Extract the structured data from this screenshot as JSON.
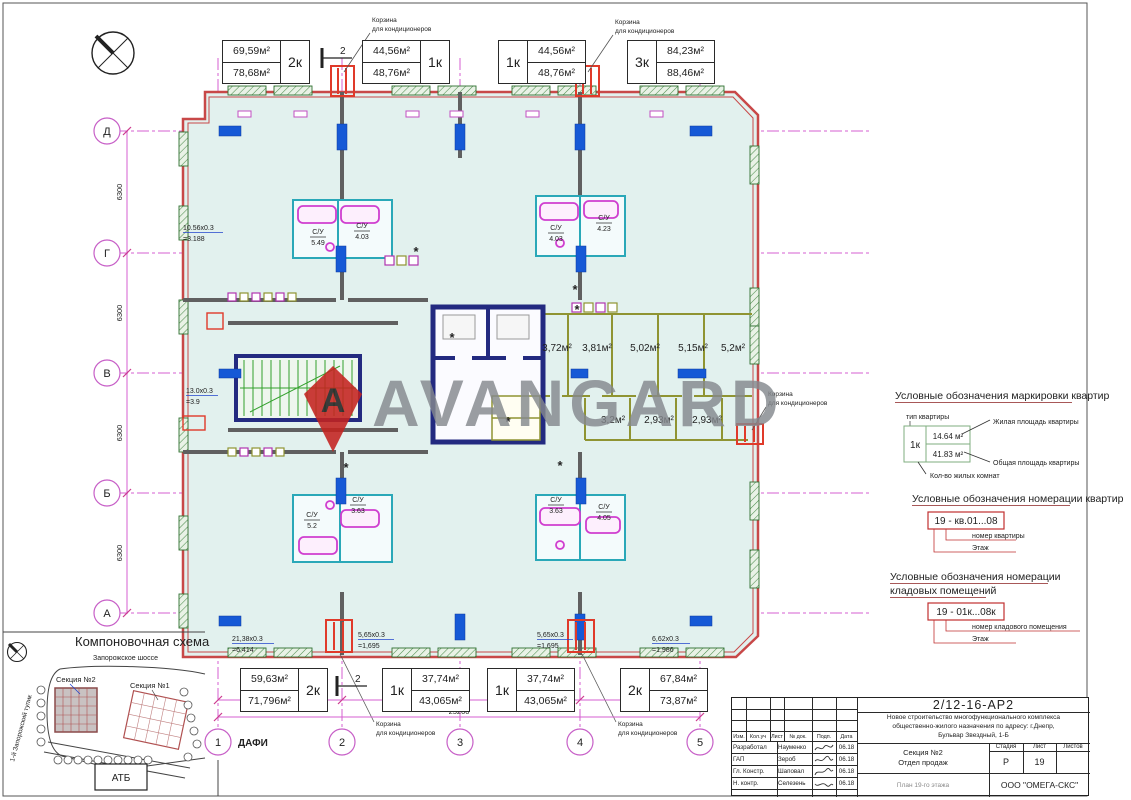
{
  "watermark": {
    "text": "AVANGARD",
    "logo_letter": "A"
  },
  "plan": {
    "section_mark": "2",
    "basket_line1": "Корзина",
    "basket_line2": "для кондиционеров",
    "apartments_top": [
      {
        "living": "69,59м²",
        "total": "78,68м²",
        "rooms": "2к"
      },
      {
        "living": "44,56м²",
        "total": "48,76м²",
        "rooms": "1к"
      },
      {
        "living": "44,56м²",
        "total": "48,76м²",
        "rooms": "1к"
      },
      {
        "living": "84,23м²",
        "total": "88,46м²",
        "rooms": "3к"
      }
    ],
    "apartments_bottom": [
      {
        "living": "59,63м²",
        "total": "71,796м²",
        "rooms": "2к"
      },
      {
        "living": "37,74м²",
        "total": "43,065м²",
        "rooms": "1к"
      },
      {
        "living": "37,74м²",
        "total": "43,065м²",
        "rooms": "1к"
      },
      {
        "living": "67,84м²",
        "total": "73,87м²",
        "rooms": "2к"
      }
    ],
    "storage_top": [
      "3,72м²",
      "3,81м²",
      "5,02м²",
      "5,15м²",
      "5,2м²"
    ],
    "storage_bottom": [
      "3,2м²",
      "2,93м²",
      "2,93м²"
    ],
    "bathrooms": [
      {
        "label": "С/У",
        "area": "5.49"
      },
      {
        "label": "С/У",
        "area": "4.03"
      },
      {
        "label": "С/У",
        "area": "4.03"
      },
      {
        "label": "С/У",
        "area": "4.23"
      },
      {
        "label": "С/У",
        "area": "5.2"
      },
      {
        "label": "С/У",
        "area": "3.63"
      },
      {
        "label": "С/У",
        "area": "3.63"
      },
      {
        "label": "С/У",
        "area": "4.05"
      }
    ],
    "balconies": [
      {
        "f": "10.56х0.3",
        "r": "=3.188"
      },
      {
        "f": "13.0х0.3",
        "r": "=3.9"
      },
      {
        "f": "21,38х0.3",
        "r": "=6,414"
      },
      {
        "f": "5,65х0.3",
        "r": "=1,695"
      },
      {
        "f": "5,65х0.3",
        "r": "=1,695"
      },
      {
        "f": "6,62х0.3",
        "r": "=1,986"
      }
    ],
    "axes_h": [
      "Д",
      "Г",
      "В",
      "Б",
      "А"
    ],
    "axes_v": [
      "1",
      "2",
      "3",
      "4",
      "5"
    ],
    "axis_note": "ДАФИ",
    "dim": "6300",
    "dim_total": "25200"
  },
  "legend1": {
    "title": "Условные обозначения маркировки квартир",
    "type_label": "тип квартиры",
    "type": "1к",
    "living": "14.64 м²",
    "total": "41.83 м²",
    "living_label": "Жилая площадь квартиры",
    "total_label": "Общая площадь квартиры",
    "rooms_label": "Кол-во жилых комнат"
  },
  "legend2": {
    "title": "Условные обозначения номерации квартир",
    "example": "19 - кв.01...08",
    "num_label": "номер квартиры",
    "floor_label": "Этаж"
  },
  "legend3": {
    "title1": "Условные обозначения номерации",
    "title2": "кладовых помещений",
    "example": "19 - 01к...08к",
    "num_label": "номер кладового помещения",
    "floor_label": "Этаж"
  },
  "site": {
    "title": "Компоновочная схема",
    "road": "Запорожское шоссе",
    "s2": "Секция №2",
    "s1": "Секция №1",
    "store": "АТБ",
    "street": "1-й Запорожский тупик"
  },
  "stamp": {
    "doc": "2/12-16-АР2",
    "project_lines": [
      "Новое строительство многофункционального комплекса",
      "общественно-жилого назначения по адресу: г.Днепр,",
      "Бульвар Звездный, 1-Б"
    ],
    "object1": "Секция №2",
    "object2": "Отдел продаж",
    "sheet_name": "План 19-го этажа",
    "company": "ООО \"ОМЕГА-СКС\"",
    "cols": [
      "Изм.",
      "Кол.уч",
      "Лист",
      "№ док.",
      "Подп.",
      "Дата"
    ],
    "stage_label": "Стадия",
    "sheet_label": "Лист",
    "sheets_label": "Листов",
    "stage": "Р",
    "sheet": "19",
    "rows": [
      {
        "role": "Разработал",
        "name": "Науменко",
        "date": "06.18"
      },
      {
        "role": "ГАП",
        "name": "Зероб",
        "date": "06.18"
      },
      {
        "role": "Гл. Констр.",
        "name": "Шаповал",
        "date": "06.18"
      },
      {
        "role": "Н. контр.",
        "name": "Селезень",
        "date": "06.18"
      }
    ]
  }
}
